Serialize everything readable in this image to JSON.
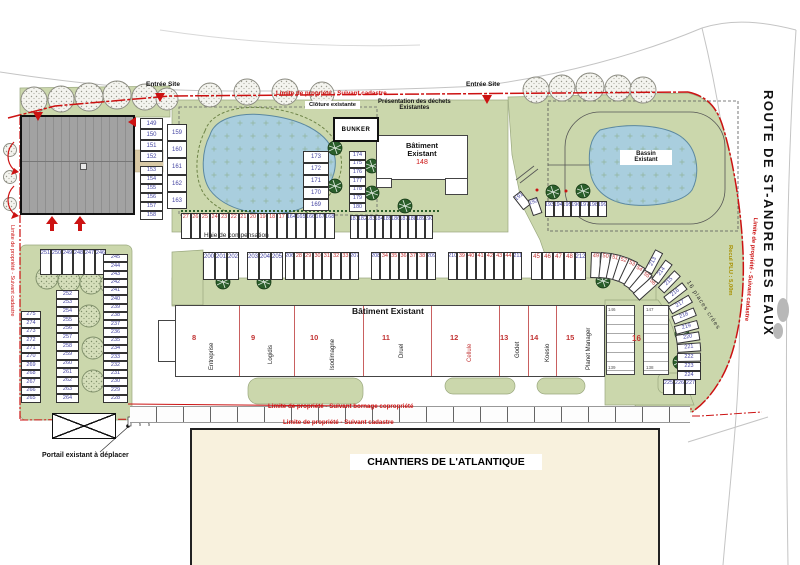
{
  "labels": {
    "entree": "Entrée Site",
    "limite_cadastre": "Limite de propriété - Suivant cadastre",
    "limite_bornage": "Limite de propriété - Suivant bornage copropriété",
    "route": "ROUTE DE ST-ANDRE DES EAUX",
    "recul": "Recul PLU : 5,00m",
    "places": "16 places crées",
    "haie": "Haie de compensation",
    "cloture": "Clôture existante",
    "dechets1": "Présentation des déchets",
    "dechets2": "Existantes",
    "bunker": "BUNKER",
    "b148_1": "Bâtiment",
    "b148_2": "Existant",
    "b148_num": "148",
    "bassin1": "Bassin",
    "bassin2": "Existant",
    "bat_central": "Bâtiment Existant",
    "chantiers": "CHANTIERS DE L'ATLANTIQUE",
    "portail": "Portail existant à déplacer"
  },
  "units": [
    {
      "num": "8",
      "name": "Entreprise"
    },
    {
      "num": "9",
      "name": "Logidis"
    },
    {
      "num": "10",
      "name": "Isodimagne"
    },
    {
      "num": "11",
      "name": "Druel"
    },
    {
      "num": "12",
      "name": "Cellule"
    },
    {
      "num": "13",
      "name": "Godet"
    },
    {
      "num": "14",
      "name": "Koesio"
    },
    {
      "num": "15",
      "name": "Planet Manager"
    },
    {
      "num": "16",
      "name": ""
    }
  ],
  "area16": {
    "label": "16",
    "tl": "146",
    "tr": "147",
    "bl": "139",
    "br": "138"
  },
  "parking": {
    "colA1": [
      "149",
      "150",
      "151",
      "152"
    ],
    "colA2": [
      "153",
      "154",
      "155",
      "156",
      "157",
      "158"
    ],
    "colB": [
      "159",
      "160",
      "161",
      "162",
      "163"
    ],
    "colC": [
      "173",
      "172",
      "171",
      "170",
      "169"
    ],
    "colD": [
      "174",
      "175",
      "176",
      "177",
      "178",
      "179",
      "180"
    ],
    "rowPond": [
      "27",
      "26",
      "25",
      "24",
      "23",
      "22",
      "21",
      "20",
      "19",
      "18",
      "17",
      "164",
      "165",
      "166",
      "167",
      "168"
    ],
    "row181": [
      "181",
      "182",
      "183",
      "184",
      "185",
      "186",
      "187",
      "188",
      "189",
      "190"
    ],
    "angled191": [
      "191",
      "192"
    ],
    "row193": [
      "193",
      "194",
      "195",
      "196",
      "197",
      "198",
      "199"
    ],
    "g1": [
      "200",
      "201",
      "202"
    ],
    "g2": [
      "203",
      "204",
      "205"
    ],
    "g3": [
      "206",
      "28",
      "29",
      "30",
      "31",
      "32",
      "33",
      "207"
    ],
    "g4": [
      "208",
      "34",
      "35",
      "36",
      "37",
      "38",
      "209"
    ],
    "g5": [
      "210",
      "39",
      "40",
      "41",
      "42",
      "43",
      "44",
      "211"
    ],
    "g6": [
      "45",
      "46",
      "47",
      "48",
      "212"
    ],
    "g7": [
      "49",
      "50",
      "51",
      "52",
      "53",
      "54",
      "55",
      "56"
    ],
    "curve": [
      "213",
      "214",
      "215",
      "216",
      "217",
      "218",
      "219",
      "220",
      "221",
      "222",
      "223",
      "224"
    ],
    "curveBottom": [
      "225",
      "226",
      "227"
    ],
    "leftTop": [
      "251",
      "250",
      "249",
      "248",
      "247",
      "246"
    ],
    "leftColRight": [
      "245",
      "244",
      "243",
      "242",
      "241",
      "240",
      "239",
      "238",
      "237",
      "236",
      "235",
      "234",
      "233",
      "232",
      "231",
      "230",
      "229",
      "228"
    ],
    "leftColMid": [
      "252",
      "253",
      "254",
      "255",
      "256",
      "257",
      "258",
      "259",
      "260",
      "261",
      "262",
      "263",
      "264"
    ],
    "leftColLeft": [
      "275",
      "274",
      "273",
      "272",
      "271",
      "270",
      "269",
      "268",
      "267",
      "266",
      "265"
    ]
  },
  "colors": {
    "boundary": "#cc1212",
    "green": "#cbd7ac",
    "water": "#a9cede",
    "existing_num": "#4545a2",
    "new_num": "#c23434"
  }
}
